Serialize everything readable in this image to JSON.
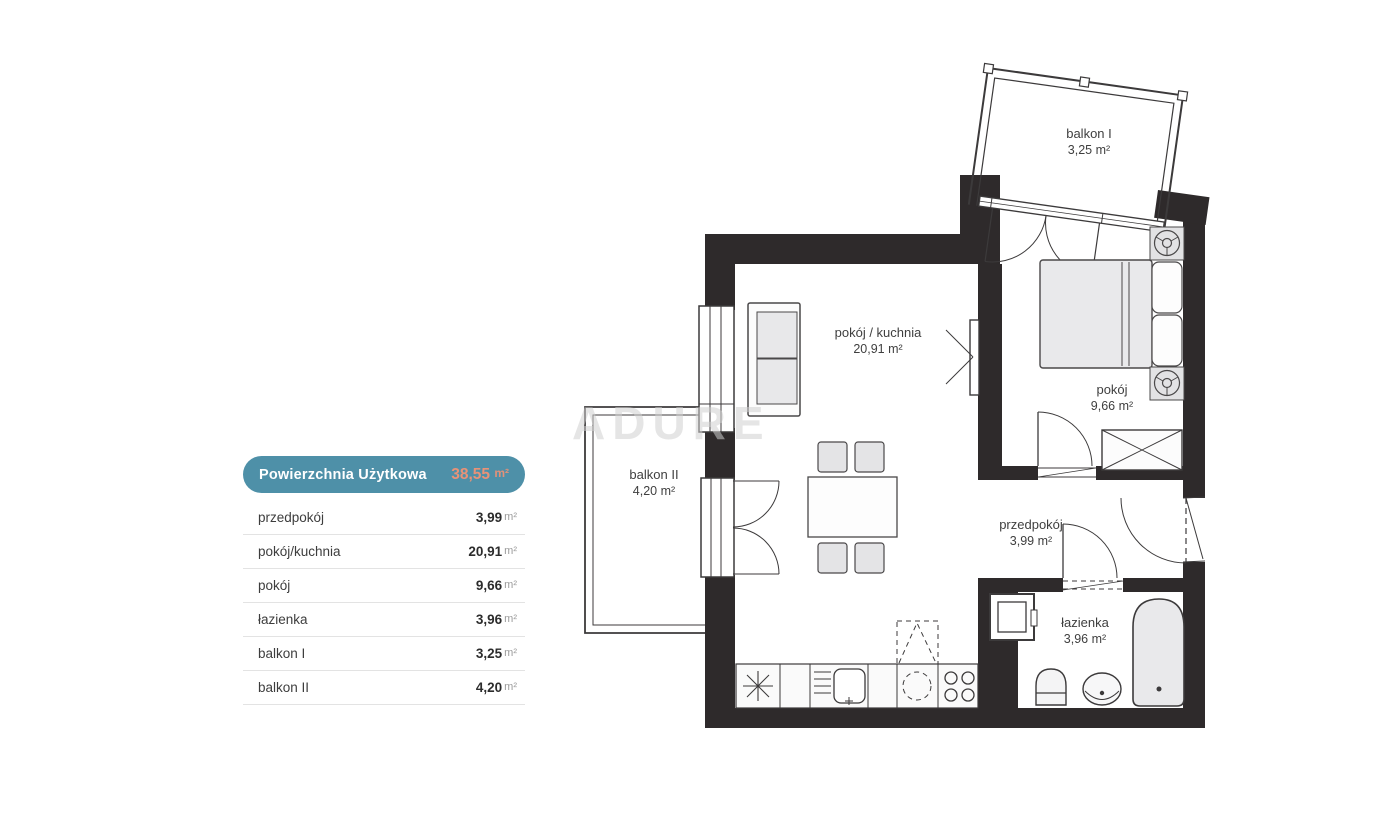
{
  "legend": {
    "header": {
      "label": "Powierzchnia Użytkowa",
      "value": "38,55",
      "unit": "m²"
    },
    "rows": [
      {
        "label": "przedpokój",
        "value": "3,99",
        "unit": "m²"
      },
      {
        "label": "pokój/kuchnia",
        "value": "20,91",
        "unit": "m²"
      },
      {
        "label": "pokój",
        "value": "9,66",
        "unit": "m²"
      },
      {
        "label": "łazienka",
        "value": "3,96",
        "unit": "m²"
      },
      {
        "label": "balkon I",
        "value": "3,25",
        "unit": "m²"
      },
      {
        "label": "balkon II",
        "value": "4,20",
        "unit": "m²"
      }
    ]
  },
  "plan": {
    "watermark": "ADURE",
    "rooms": [
      {
        "id": "balkon-1",
        "label": "balkon I",
        "area": "3,25 m²"
      },
      {
        "id": "pokoj-kuchnia",
        "label": "pokój / kuchnia",
        "area": "20,91 m²"
      },
      {
        "id": "pokoj",
        "label": "pokój",
        "area": "9,66 m²"
      },
      {
        "id": "balkon-2",
        "label": "balkon II",
        "area": "4,20 m²"
      },
      {
        "id": "przedpokoj",
        "label": "przedpokój",
        "area": "3,99 m²"
      },
      {
        "id": "lazienka",
        "label": "łazienka",
        "area": "3,96 m²"
      }
    ]
  },
  "colors": {
    "legend_header_bg": "#4e90a8",
    "legend_header_value": "#e99277",
    "wall": "#2e2a2b",
    "line": "#3c3a3b",
    "furniture_fill": "#e8e8ea"
  }
}
